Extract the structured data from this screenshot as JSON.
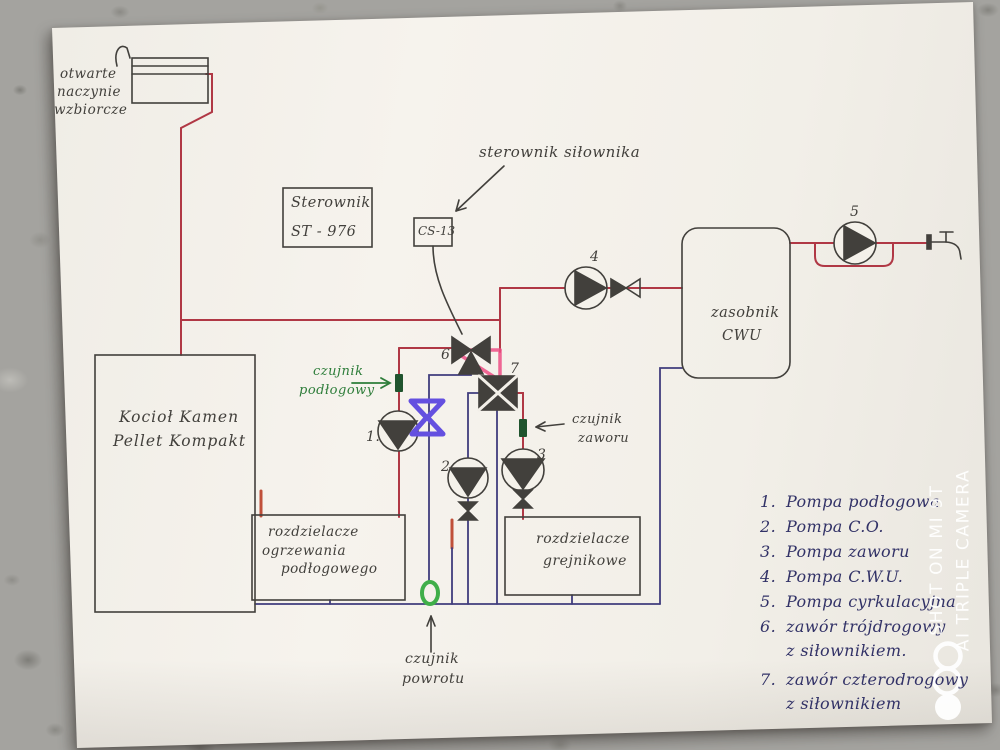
{
  "labels": {
    "expansion_vessel": {
      "lines": [
        "otwarte",
        "naczynie",
        "wzbiorcze"
      ]
    },
    "controller_box": {
      "line1": "Sterownik",
      "line2": "ST - 976"
    },
    "actuator_controller": {
      "text": "sterownik siłownika"
    },
    "actuator_module": {
      "text": "CS-13"
    },
    "boiler": {
      "line1": "Kocioł Kamen",
      "line2": "Pellet Kompakt"
    },
    "floor_manifold": {
      "lines": [
        "rozdzielacze",
        "ogrzewania",
        "podłogowego"
      ]
    },
    "radiator_manifold": {
      "lines": [
        "rozdzielacze",
        "grejnikowe"
      ]
    },
    "dhw_tank": {
      "line1": "zasobnik",
      "line2": "CWU"
    },
    "floor_sensor": {
      "line1": "czujnik",
      "line2": "podłogowy"
    },
    "valve_sensor": {
      "line1": "czujnik",
      "line2": "zaworu"
    },
    "return_sensor": {
      "line1": "czujnik",
      "line2": "powrotu"
    }
  },
  "component_numbers": {
    "pump1": "1.",
    "pump2": "2",
    "pump3": "3",
    "pump4": "4",
    "pump5": "5",
    "valve6": "6",
    "valve7": "7"
  },
  "legend": {
    "items": [
      {
        "num": "1.",
        "text": "Pompa podłogowa",
        "text2": ""
      },
      {
        "num": "2.",
        "text": "Pompa C.O.",
        "text2": ""
      },
      {
        "num": "3.",
        "text": "Pompa zaworu",
        "text2": ""
      },
      {
        "num": "4.",
        "text": "Pompa C.W.U.",
        "text2": ""
      },
      {
        "num": "5.",
        "text": "Pompa cyrkulacyjna",
        "text2": ""
      },
      {
        "num": "6.",
        "text": "zawór trójdrogowy",
        "text2": "z siłownikiem."
      },
      {
        "num": "7.",
        "text": "zawór czterodrogowy",
        "text2": "z siłownikiem"
      }
    ]
  },
  "watermark": {
    "line1": "SHOT ON MI 9T",
    "line2": "AI TRIPLE CAMERA"
  },
  "colors": {
    "supply_pipe": "#b03845",
    "return_pipe": "#403d7d",
    "highlight_pink": "#ee4f86",
    "marker_purple": "#6450e0",
    "sensor_green": "#2e7d3a",
    "ink": "#42403c",
    "legend_ink": "#323267",
    "paper": "#f4f1ea",
    "watermark": "#ffffff"
  }
}
